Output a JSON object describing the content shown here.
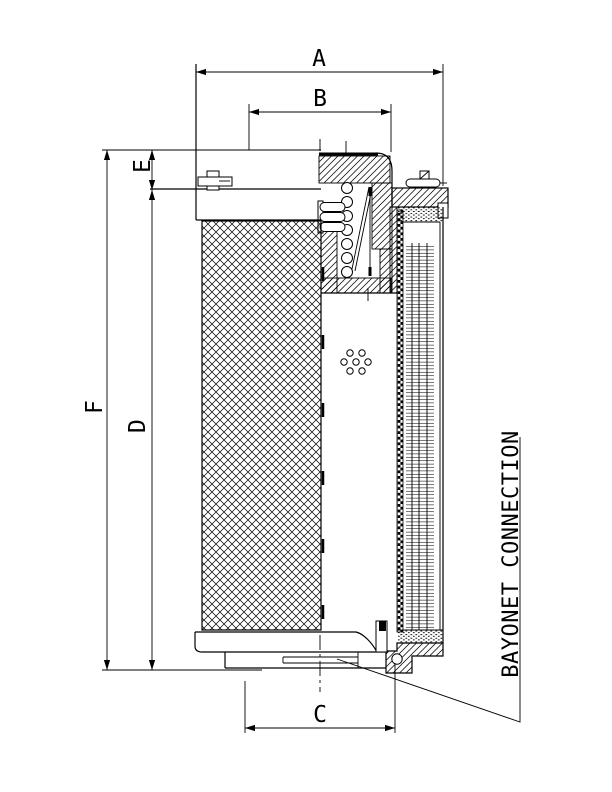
{
  "colors": {
    "line": "#000000",
    "background": "#ffffff"
  },
  "dimension_labels": {
    "a": "A",
    "b": "B",
    "c": "C",
    "d": "D",
    "e": "E",
    "f": "F"
  },
  "annotations": {
    "bayonet_connection": "BAYONET CONNECTION"
  }
}
